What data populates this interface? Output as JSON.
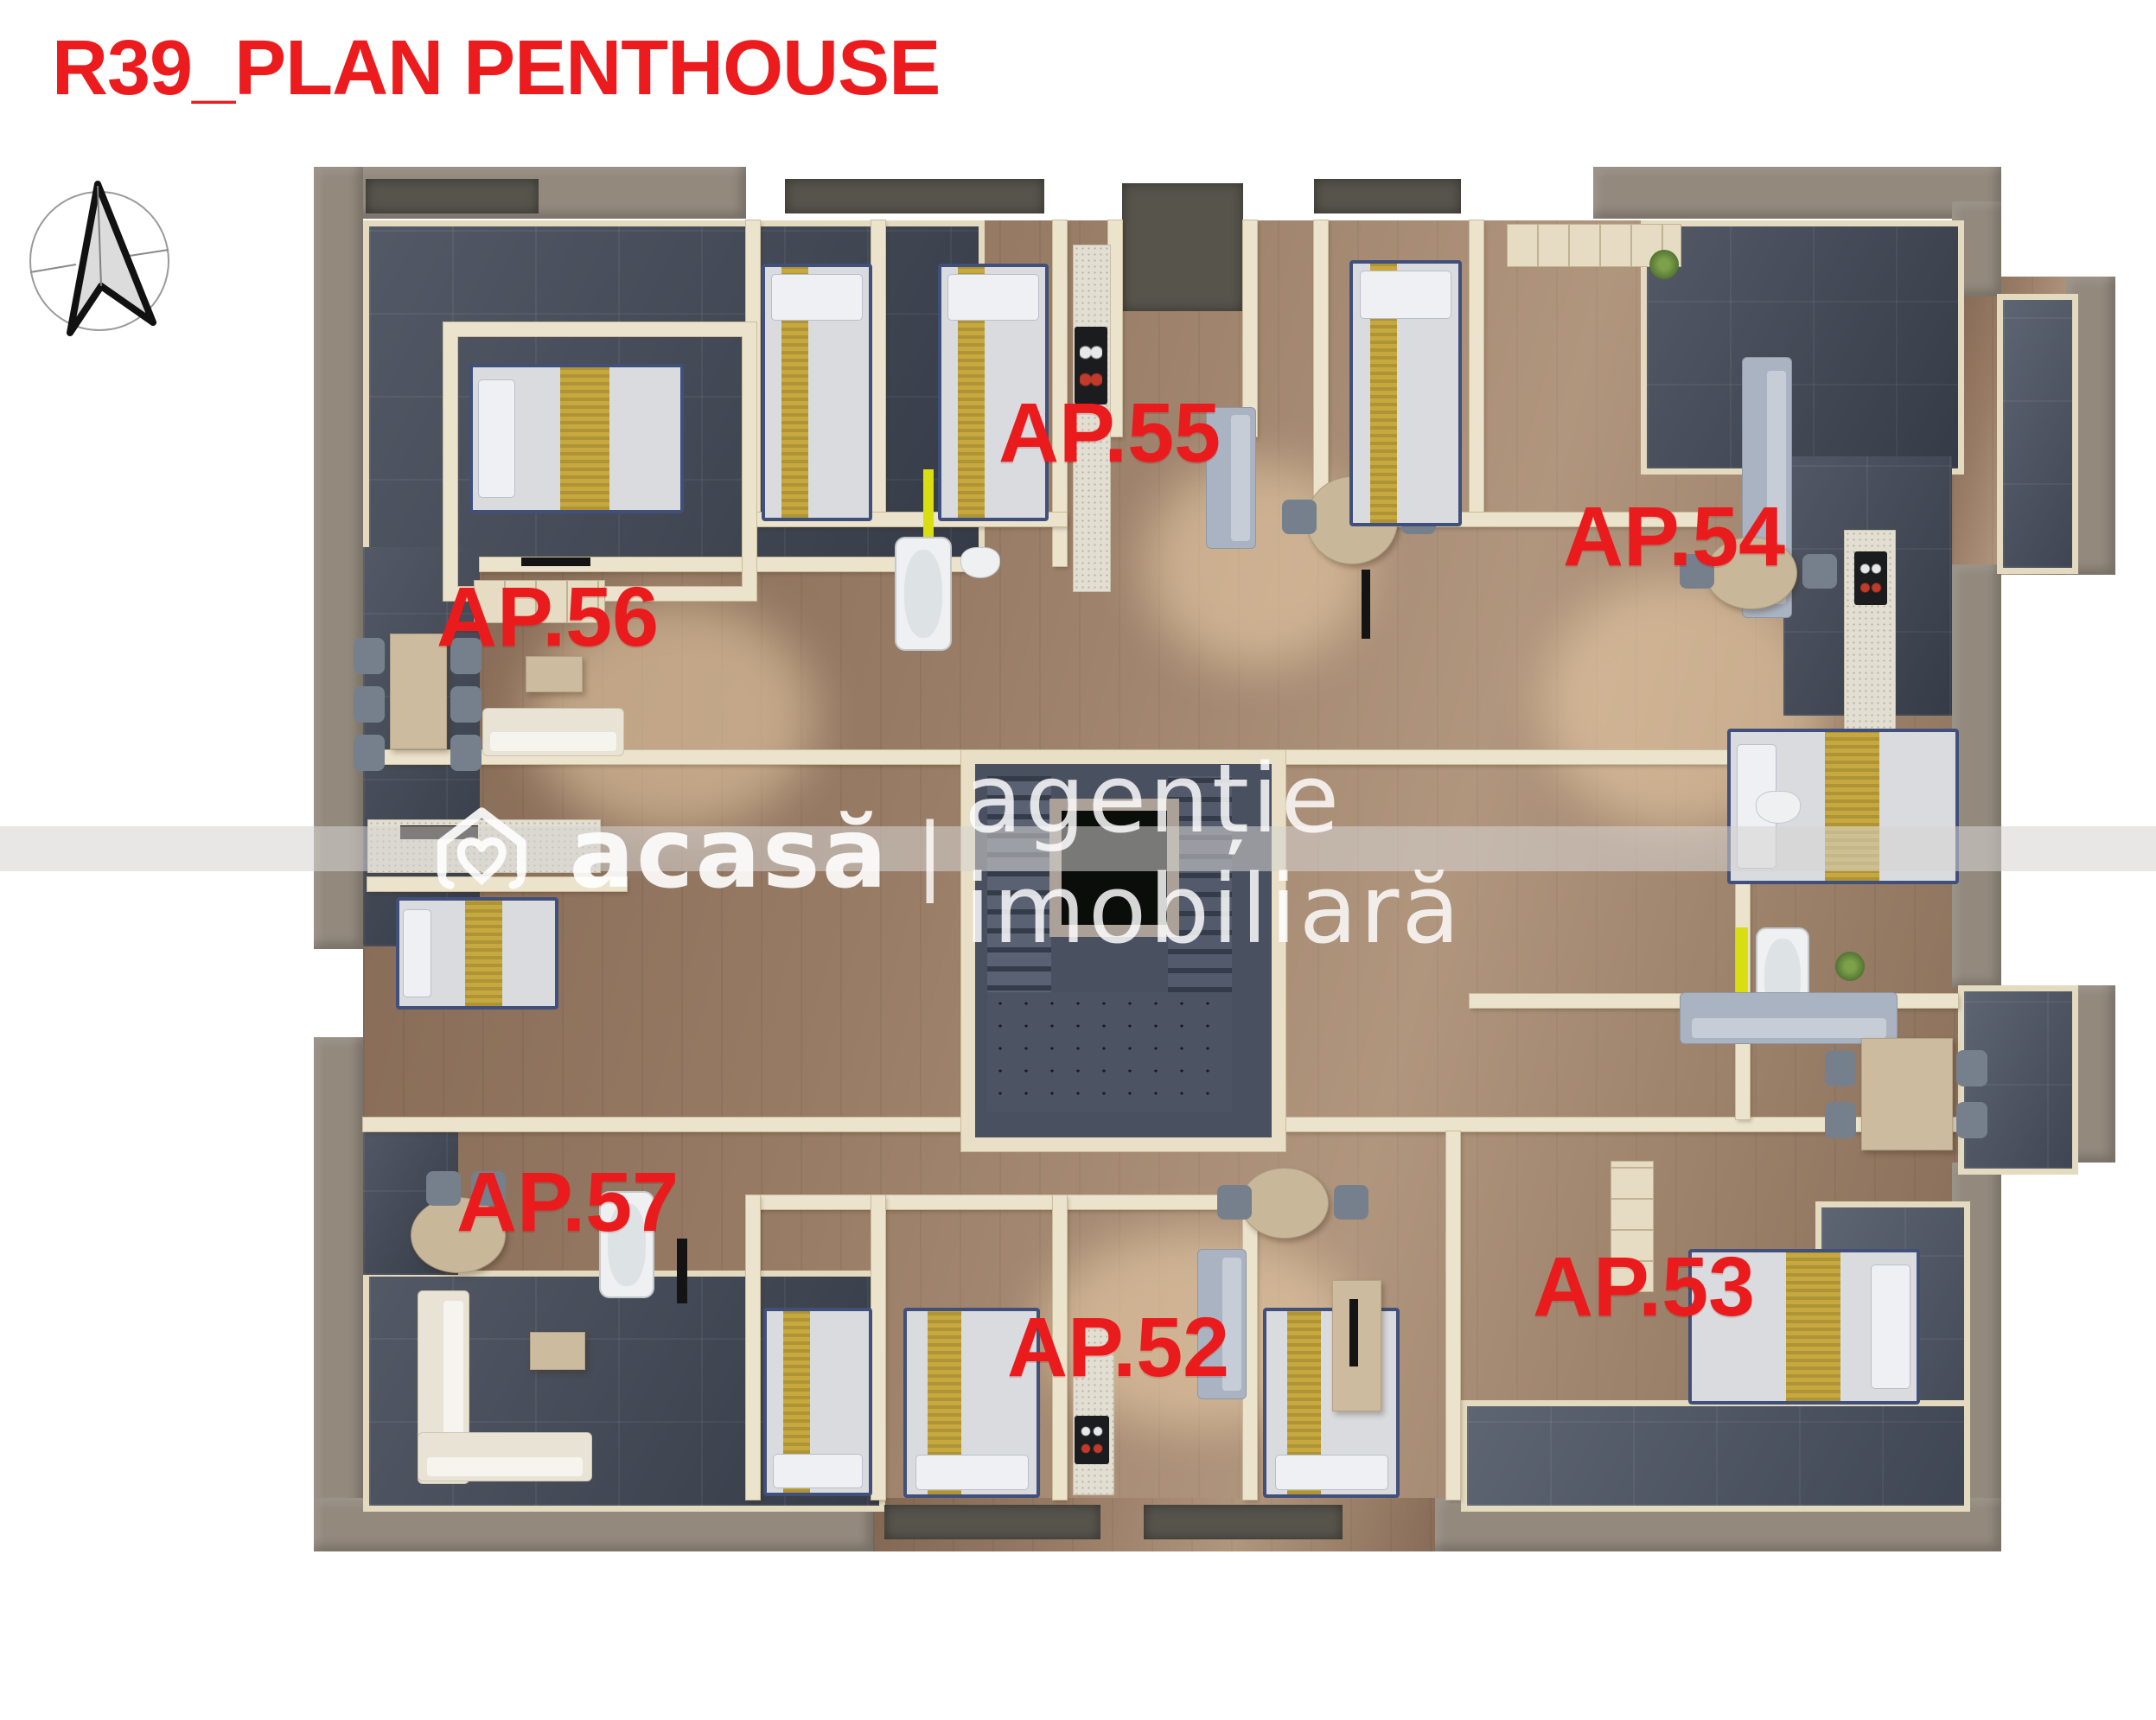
{
  "header": {
    "title": "R39_PLAN PENTHOUSE"
  },
  "icons": {
    "compass": "north-arrow-icon",
    "logo": "house-heart-icon"
  },
  "watermark": {
    "brand": "acasă",
    "separator": "|",
    "tagline": "agenție imobiliară"
  },
  "apartments": [
    {
      "label": "AP.56"
    },
    {
      "label": "AP.55"
    },
    {
      "label": "AP.54"
    },
    {
      "label": "AP.57"
    },
    {
      "label": "AP.52"
    },
    {
      "label": "AP.53"
    }
  ],
  "palette": {
    "accent_red": "#ec1b1e",
    "terrace_slate": "#3f4654",
    "parapet_taupe": "#93897d",
    "wall_cream": "#ece3cc",
    "floor_wood": "#977b65",
    "accent_lime": "#d9de12",
    "core_concrete": "#4c5362",
    "watermark_white": "#ffffff"
  }
}
